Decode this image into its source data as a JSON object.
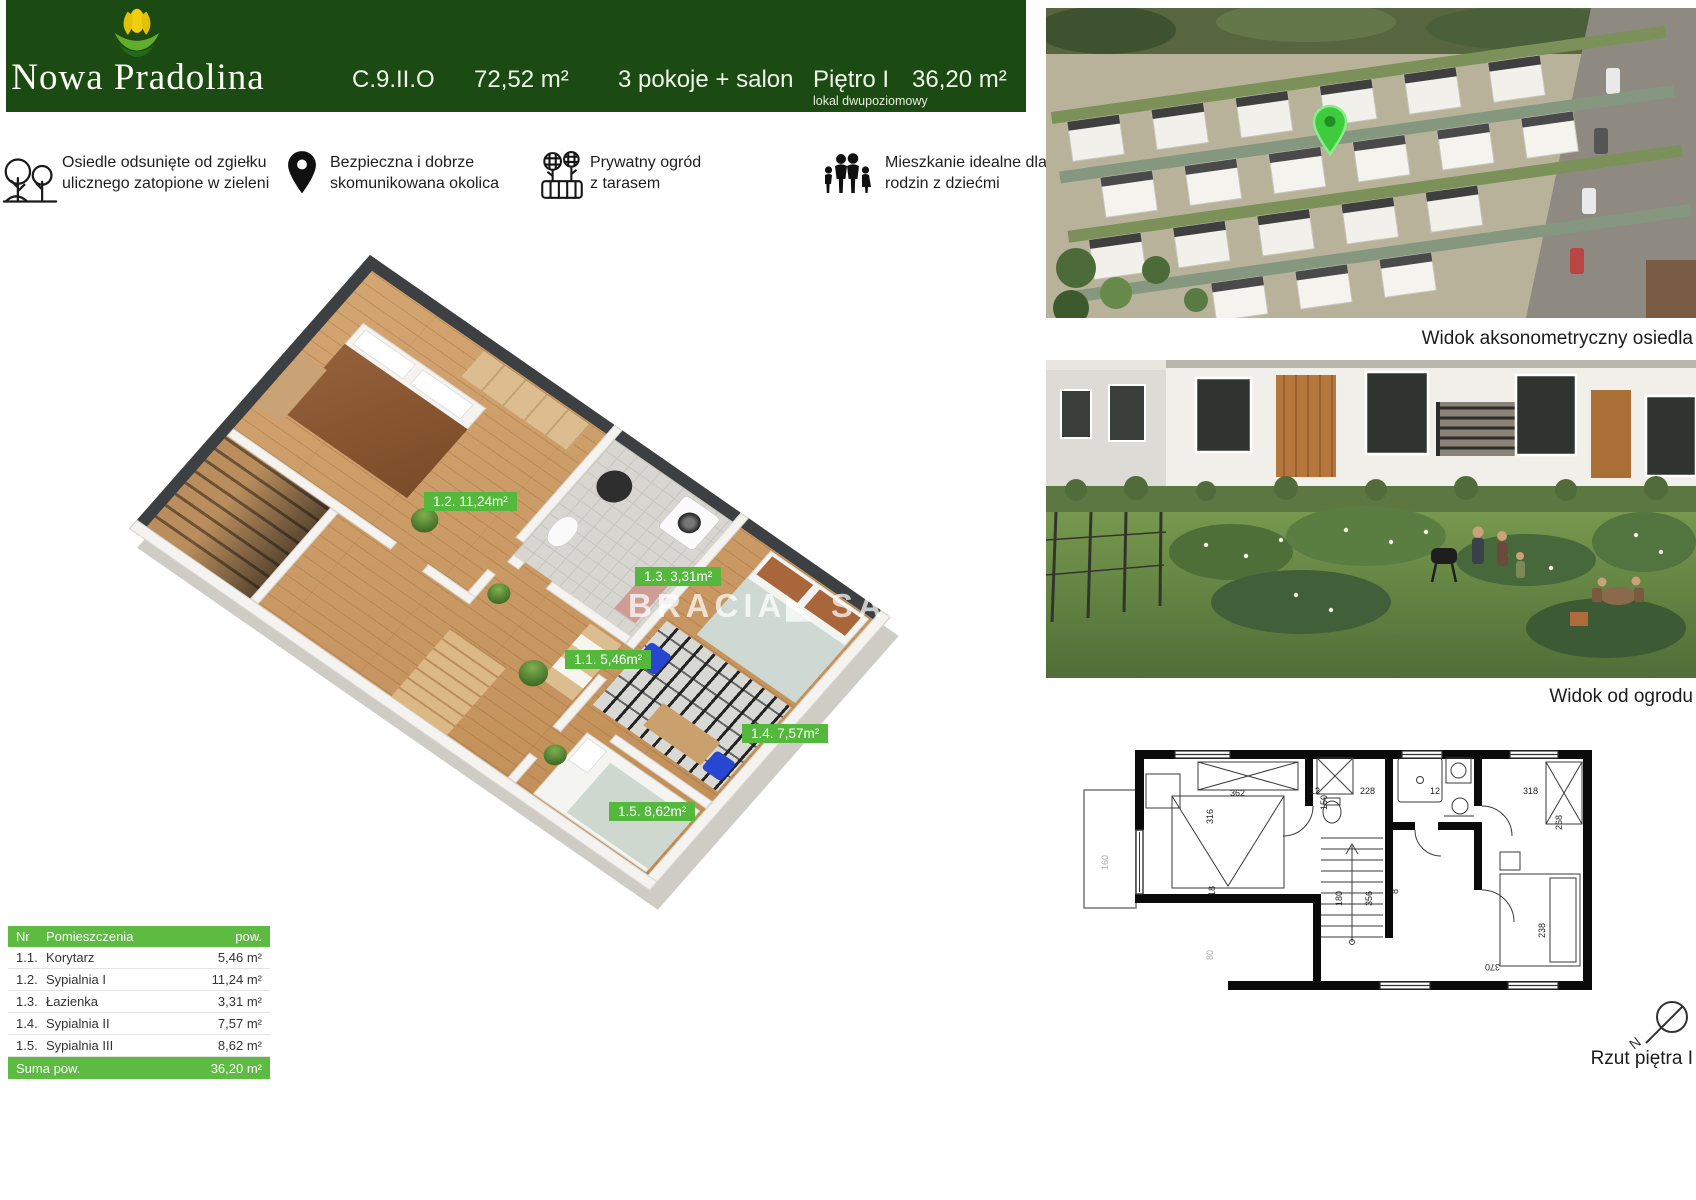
{
  "header": {
    "brand": "Nowa Pradolina",
    "unit": "C.9.II.O",
    "total_area": "72,52 m²",
    "rooms": "3 pokoje + salon",
    "floor": "Piętro I",
    "floor_note": "lokal dwupoziomowy",
    "floor_area": "36,20 m²"
  },
  "features": [
    {
      "icon": "trees-icon",
      "text": "Osiedle odsunięte od zgiełku\nulicznego zatopione  w zieleni"
    },
    {
      "icon": "location-pin-icon",
      "text": "Bezpieczna i dobrze\nskomunikowana okolica"
    },
    {
      "icon": "garden-icon",
      "text": "Prywatny ogród\nz tarasem"
    },
    {
      "icon": "family-icon",
      "text": "Mieszkanie idealne dla\nrodzin z dziećmi"
    }
  ],
  "plan3d": {
    "watermark": "BRACIA◣ SAD",
    "labels": [
      {
        "room": "1.2",
        "text": "1.2. 11,24m²"
      },
      {
        "room": "1.3",
        "text": "1.3. 3,31m²"
      },
      {
        "room": "1.1",
        "text": "1.1. 5,46m²"
      },
      {
        "room": "1.4",
        "text": "1.4. 7,57m²"
      },
      {
        "room": "1.5",
        "text": "1.5. 8,62m²"
      }
    ]
  },
  "table": {
    "headers": {
      "nr": "Nr",
      "name": "Pomieszczenia",
      "area": "pow."
    },
    "rows": [
      {
        "nr": "1.1.",
        "name": "Korytarz",
        "area": "5,46 m²"
      },
      {
        "nr": "1.2.",
        "name": "Sypialnia I",
        "area": "11,24 m²"
      },
      {
        "nr": "1.3.",
        "name": "Łazienka",
        "area": "3,31 m²"
      },
      {
        "nr": "1.4.",
        "name": "Sypialnia II",
        "area": "7,57 m²"
      },
      {
        "nr": "1.5.",
        "name": "Sypialnia III",
        "area": "8,62 m²"
      }
    ],
    "total_label": "Suma pow.",
    "total_area": "36,20 m²"
  },
  "right_panel": {
    "caption_top": "Widok aksonometryczny osiedla",
    "caption_middle": "Widok od ogrodu",
    "caption_bottom": "Rzut piętra I"
  },
  "floorplan_2d": {
    "dimensions": [
      {
        "t": "362",
        "x": 150,
        "y": 98,
        "r": 0
      },
      {
        "t": "12",
        "x": 230,
        "y": 96,
        "r": 0
      },
      {
        "t": "150",
        "x": 247,
        "y": 112,
        "r": -90
      },
      {
        "t": "228",
        "x": 280,
        "y": 96,
        "r": 0
      },
      {
        "t": "12",
        "x": 350,
        "y": 96,
        "r": 0
      },
      {
        "t": "318",
        "x": 443,
        "y": 96,
        "r": 0
      },
      {
        "t": "316",
        "x": 133,
        "y": 126,
        "r": -90
      },
      {
        "t": "268",
        "x": 482,
        "y": 132,
        "r": -90
      },
      {
        "t": "18",
        "x": 135,
        "y": 198,
        "r": -90
      },
      {
        "t": "80",
        "x": 133,
        "y": 262,
        "r": -90,
        "faint": true
      },
      {
        "t": "160",
        "x": 28,
        "y": 172,
        "r": -90,
        "faint": true
      },
      {
        "t": "356",
        "x": 292,
        "y": 208,
        "r": -90
      },
      {
        "t": "180",
        "x": 262,
        "y": 208,
        "r": -90
      },
      {
        "t": "8",
        "x": 318,
        "y": 196,
        "r": -90
      },
      {
        "t": "370",
        "x": 420,
        "y": 266,
        "r": 180
      },
      {
        "t": "238",
        "x": 465,
        "y": 240,
        "r": -90
      }
    ]
  },
  "colors": {
    "brand_green_dark": "#1c4a13",
    "accent_green": "#5dbb42",
    "pin_green": "#3ecb3e"
  }
}
